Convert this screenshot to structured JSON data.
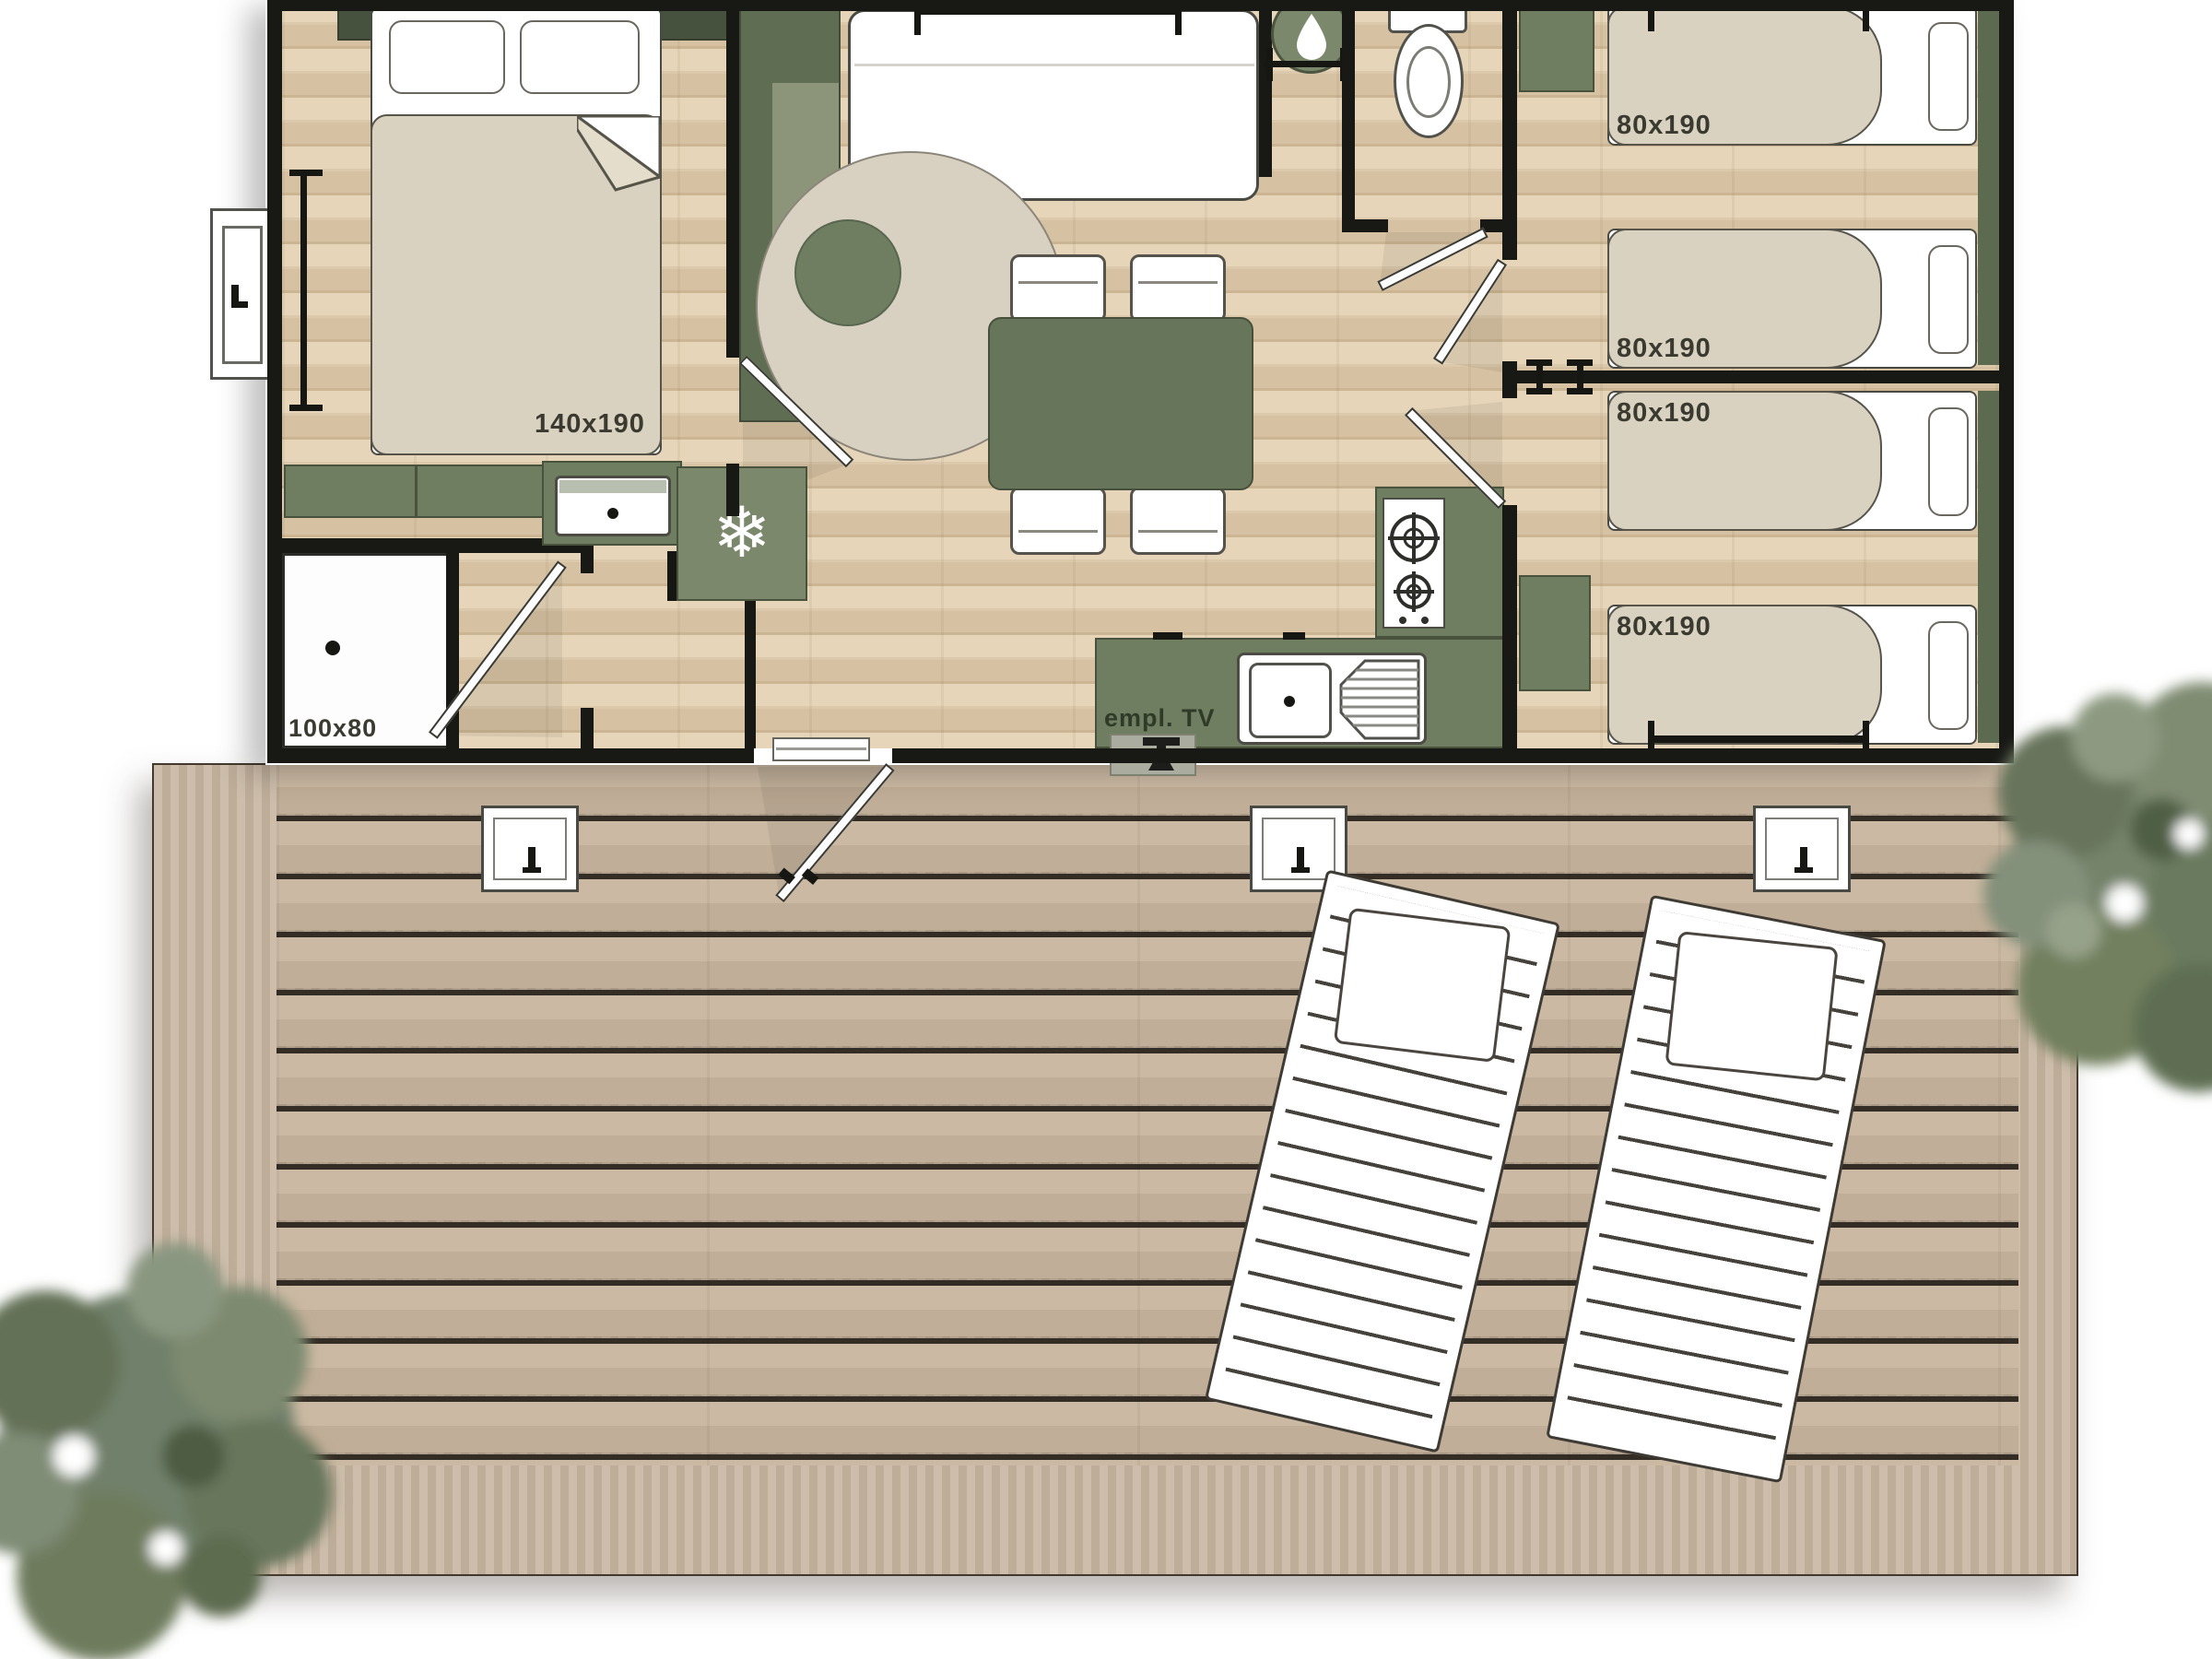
{
  "floorplan": {
    "labels": {
      "master_bed_size": "140x190",
      "shower_size": "100x80",
      "tv_spot": "empl. TV"
    },
    "beds": [
      {
        "size": "80x190"
      },
      {
        "size": "80x190"
      },
      {
        "size": "80x190"
      },
      {
        "size": "80x190"
      }
    ],
    "icons": {
      "snowflake": "❄"
    },
    "colors": {
      "furniture_green": "#6f7e61",
      "dark_green_pelmet": "#47523e",
      "wall_black": "#181815",
      "interior_wood": "#dcc9ab",
      "deck_wood": "#c1ae98",
      "mattress_beige": "#d9d2c0",
      "tree_green": "#75836a"
    }
  }
}
